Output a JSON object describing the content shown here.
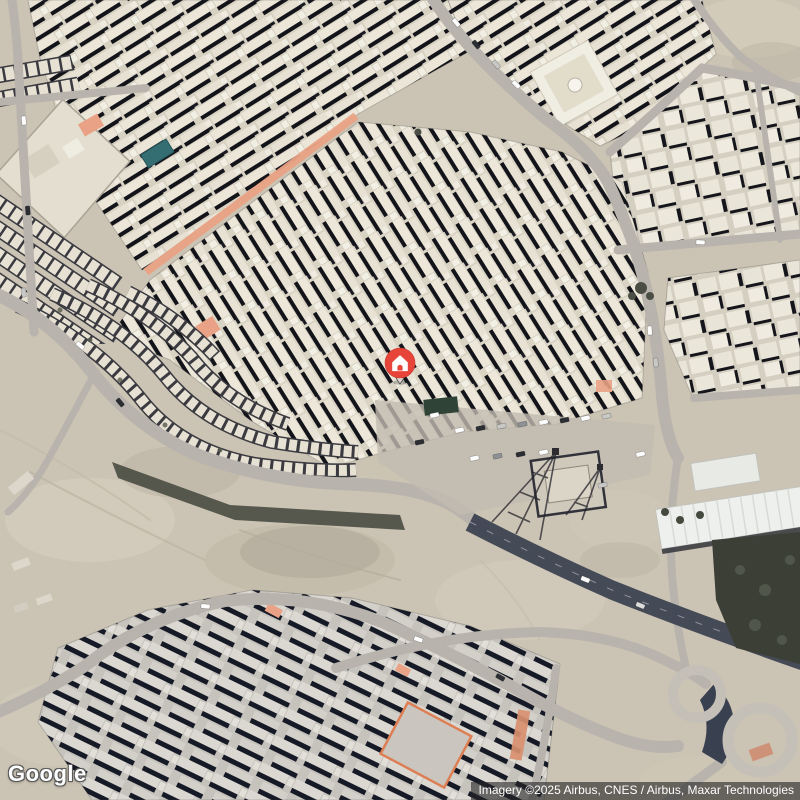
{
  "view": {
    "app": "maps-satellite-view",
    "description": "satellite imagery of a desert city district with a dropped home marker"
  },
  "branding": {
    "logo_text": "Google"
  },
  "attribution": {
    "text": "Imagery ©2025 Airbus, CNES / Airbus, Maxar Technologies"
  },
  "marker": {
    "label": "home",
    "x": 400,
    "y": 385
  },
  "colors": {
    "marker-red": "#e8453a",
    "sand": "#cbc3b3",
    "road": "#b8b4ad",
    "road-dark": "#3f4553",
    "building": "#eae5d7",
    "building-shadow": "#13131a",
    "salmon-street": "#e9a285"
  }
}
